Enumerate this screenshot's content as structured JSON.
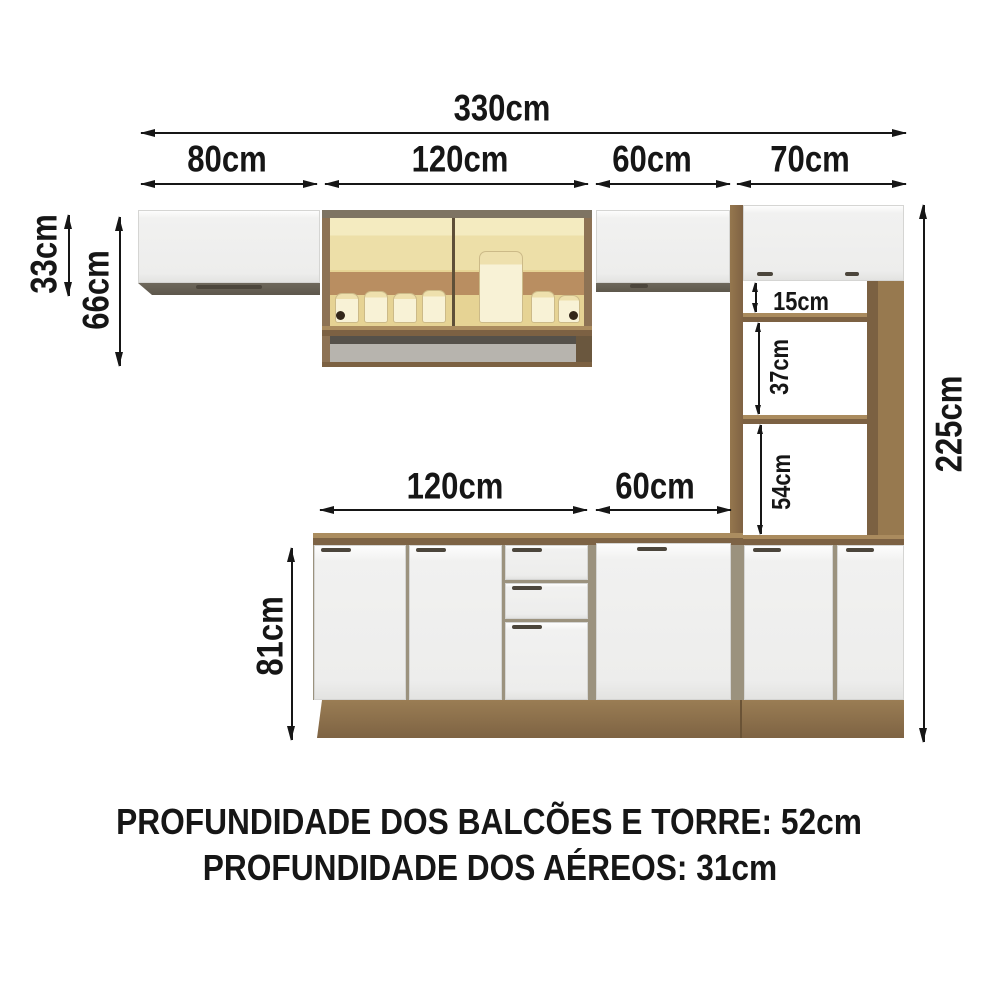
{
  "diagram": {
    "top": {
      "total_width": "330cm",
      "sections": [
        "80cm",
        "120cm",
        "60cm",
        "70cm"
      ]
    },
    "left": {
      "upper_cabinet_height": "33cm",
      "glass_cabinet_height": "66cm"
    },
    "right": {
      "total_height": "225cm"
    },
    "base": {
      "sections": [
        "120cm",
        "60cm"
      ],
      "height": "81cm"
    },
    "tower": {
      "gaps": [
        "15cm",
        "37cm",
        "54cm"
      ]
    }
  },
  "footer": {
    "line1": "PROFUNDIDADE DOS BALCÕES E TORRE: 52cm",
    "line2": "PROFUNDIDADE DOS AÉREOS: 31cm"
  },
  "colors": {
    "dimension_ink": "#161616",
    "wood": "#8f7450",
    "wood_light": "#aa8b5e",
    "wood_dark": "#6d573c",
    "white_door": "#f1f1f0",
    "glass_amber": "#eddfa8",
    "glass_band": "#b98e61",
    "niche_gray": "#b6b3ad"
  }
}
